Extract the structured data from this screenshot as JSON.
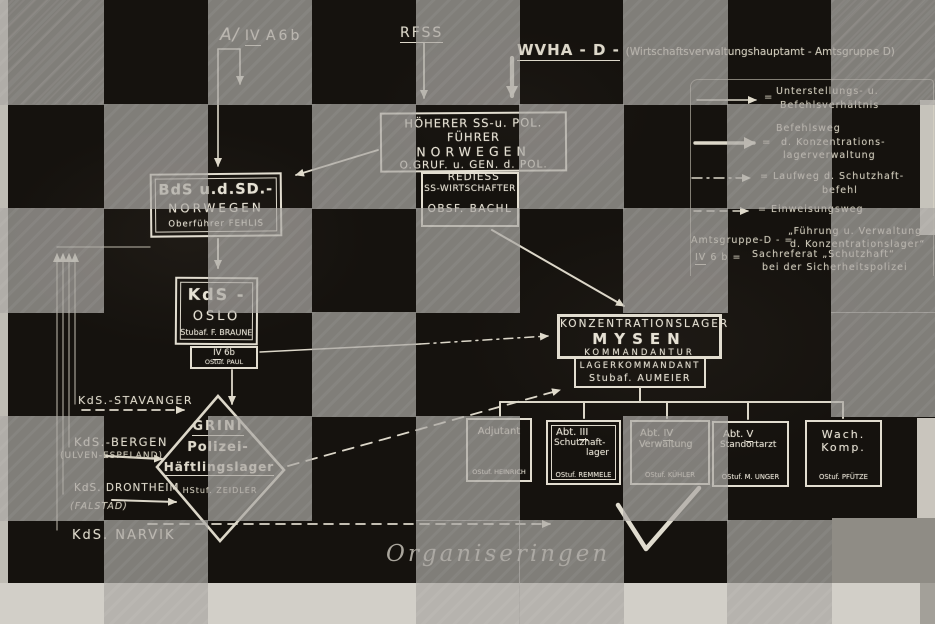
{
  "top": {
    "amt_prefix": "A/",
    "amt_ref": "IV",
    "amt_suffix": "A6b",
    "rfss": "RFSS",
    "wvha_main": "WVHA - D -",
    "wvha_paren": "(Wirtschaftsverwaltungshauptamt - Amtsgruppe D)"
  },
  "legend": {
    "eq": "=",
    "items": [
      {
        "arrow": "solid-thin",
        "lines": [
          "Unterstellungs- u.",
          "Befehlsverhältnis"
        ]
      },
      {
        "arrow": "solid-thick",
        "lines": [
          "Befehlsweg",
          "d. Konzentrations-",
          "lagerverwaltung"
        ]
      },
      {
        "arrow": "dash-dot",
        "lines": [
          "= Laufweg d. Schutzhaft-",
          "befehl"
        ]
      },
      {
        "arrow": "dashed",
        "lines": [
          "= Einweisungsweg"
        ]
      }
    ],
    "definitions": [
      {
        "term": "Amtsgruppe-D - =",
        "lines": [
          "„Führung u. Verwaltung",
          "d. Konzentrationslager“"
        ]
      },
      {
        "term_ref": "IV",
        "term_rest": " 6 b =",
        "lines": [
          "Sachreferat „Schutzhaft“",
          "bei der Sicherheitspolizei"
        ]
      }
    ]
  },
  "boxes": {
    "hsspf": {
      "lines": [
        "HÖHERER SS-u. POL. FÜHRER",
        "NORWEGEN",
        "O.GRUF. u. GEN. d. POL. REDIESS"
      ]
    },
    "wirtschafter": {
      "lines": [
        "SS-WIRTSCHAFTER",
        "OBSF. BACHL"
      ]
    },
    "bds": {
      "lines": [
        "BdS u.d.SD.-",
        "NORWEGEN",
        "Oberführer FEHLIS"
      ]
    },
    "kds_oslo": {
      "lines": [
        "KdS -",
        "OSLO",
        "Stubaf. F. BRAUNE"
      ]
    },
    "iv6b": {
      "ref": "IV",
      "rest": " 6b",
      "name": "OStuf. PAUL"
    },
    "mysen": {
      "lines": [
        "KONZENTRATIONSLAGER",
        "MYSEN",
        "KOMMANDANTUR"
      ]
    },
    "lagerkommandant": {
      "lines": [
        "LAGERKOMMANDANT",
        "Stubaf. AUMEIER"
      ]
    },
    "adjutant": {
      "title": "Adjutant",
      "name": "OStuf. HEINRICH"
    },
    "abt3": {
      "prefix": "Abt. ",
      "ref": "III",
      "lines": [
        "Schutzhaft-",
        "lager"
      ],
      "name": "OStuf. REMMELE"
    },
    "abt4": {
      "prefix": "Abt. ",
      "ref": "IV",
      "lines": [
        "Verwaltung"
      ],
      "name": "OStuf. KÜHLER"
    },
    "abt5": {
      "prefix": "Abt. ",
      "ref": "V",
      "lines": [
        "Standortarzt"
      ],
      "name": "OStuf. M. UNGER"
    },
    "wach": {
      "lines": [
        "Wach.",
        "Komp."
      ],
      "name": "OStuf. PFÜTZE"
    },
    "grini": {
      "title": "GRINI",
      "lines": [
        "Polizei-",
        "Häftlingslager"
      ],
      "name": "HStuf. ZEIDLER"
    }
  },
  "kds": {
    "stavanger": "KdS.-STAVANGER",
    "bergen": "KdS.-BERGEN",
    "bergen_sub": "(ULVEN-ESPELAND)",
    "drontheim": "KdS. DRONTHEIM",
    "drontheim_sub": "(FALSTAD)",
    "narvik": "KdS. NARVIK"
  },
  "caption": "Organiseringen",
  "colors": {
    "chalk": "#dcd7c9",
    "background": "#15120e",
    "overlay_gray": "#aaa8a3",
    "page_light": "#d2cfc8"
  },
  "overlay": {
    "rows": 6,
    "cols": 9,
    "grid": [
      [
        1,
        0,
        1,
        0,
        1,
        0,
        1,
        0,
        1
      ],
      [
        0,
        1,
        0,
        1,
        0,
        1,
        0,
        1,
        0
      ],
      [
        1,
        0,
        1,
        0,
        1,
        0,
        1,
        0,
        1
      ],
      [
        0,
        0,
        0,
        1,
        0,
        0,
        0,
        0,
        1
      ],
      [
        1,
        0,
        1,
        0,
        1,
        0,
        1,
        0,
        0
      ],
      [
        0,
        1,
        0,
        0,
        1,
        1,
        0,
        1,
        0
      ]
    ]
  }
}
